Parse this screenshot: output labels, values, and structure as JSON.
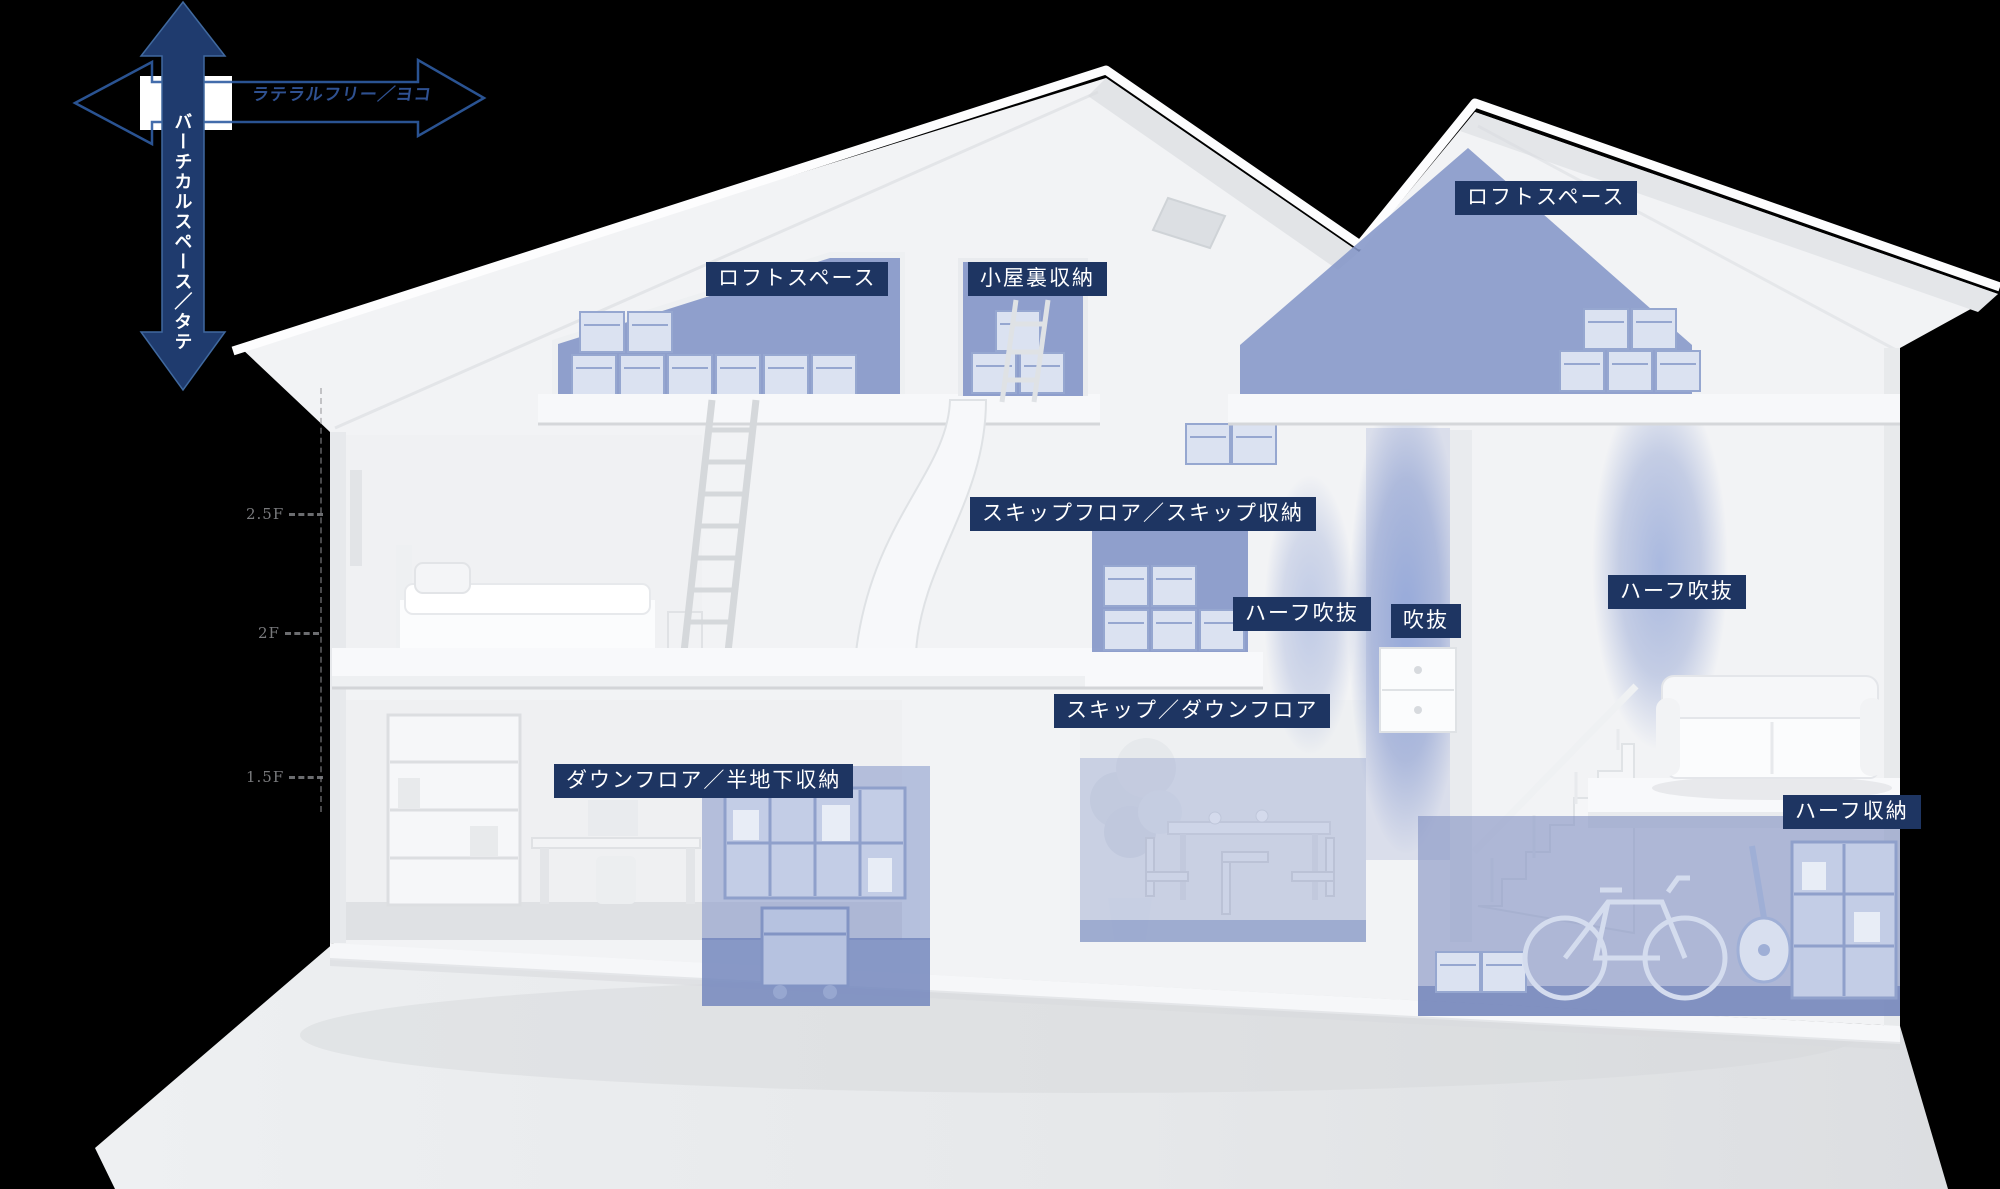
{
  "page": {
    "background": "#000000",
    "width": 2000,
    "height": 1189
  },
  "axes": {
    "vertical": {
      "label": "バーチカルスペース／タテ",
      "color": "#1f3b6e"
    },
    "horizontal": {
      "label": "ラテラルフリー／ヨコ",
      "color": "#2f5ca2"
    }
  },
  "floor_markers": [
    {
      "id": "level-2-5f",
      "label": "2.5F",
      "x": 246,
      "y": 505
    },
    {
      "id": "level-2f",
      "label": "2F",
      "x": 258,
      "y": 624
    },
    {
      "id": "level-1-5f",
      "label": "1.5F",
      "x": 246,
      "y": 768
    }
  ],
  "room_labels": [
    {
      "id": "loft-left",
      "text": "ロフトスペース",
      "x": 706,
      "y": 262
    },
    {
      "id": "attic-storage",
      "text": "小屋裏収納",
      "x": 968,
      "y": 262
    },
    {
      "id": "loft-right",
      "text": "ロフトスペース",
      "x": 1455,
      "y": 181
    },
    {
      "id": "skip-floor",
      "text": "スキップフロア／スキップ収納",
      "x": 970,
      "y": 497
    },
    {
      "id": "half-void-left",
      "text": "ハーフ吹抜",
      "x": 1233,
      "y": 597
    },
    {
      "id": "void",
      "text": "吹抜",
      "x": 1391,
      "y": 604
    },
    {
      "id": "half-void-right",
      "text": "ハーフ吹抜",
      "x": 1608,
      "y": 575
    },
    {
      "id": "skip-down-floor",
      "text": "スキップ／ダウンフロア",
      "x": 1054,
      "y": 694
    },
    {
      "id": "down-floor",
      "text": "ダウンフロア／半地下収納",
      "x": 554,
      "y": 764
    },
    {
      "id": "half-storage",
      "text": "ハーフ収納",
      "x": 1783,
      "y": 795
    }
  ],
  "colors": {
    "badge_bg": "#1e3562",
    "badge_text": "#ffffff",
    "zone_blue": "#8496c8",
    "crate_fill": "#dbe2f1",
    "crate_edge": "#96a7d0",
    "arrow_navy": "#1f3b6e",
    "arrow_outline": "#2f5ca2",
    "marker_gray": "#8f9093",
    "house_white": "#f2f3f5"
  }
}
